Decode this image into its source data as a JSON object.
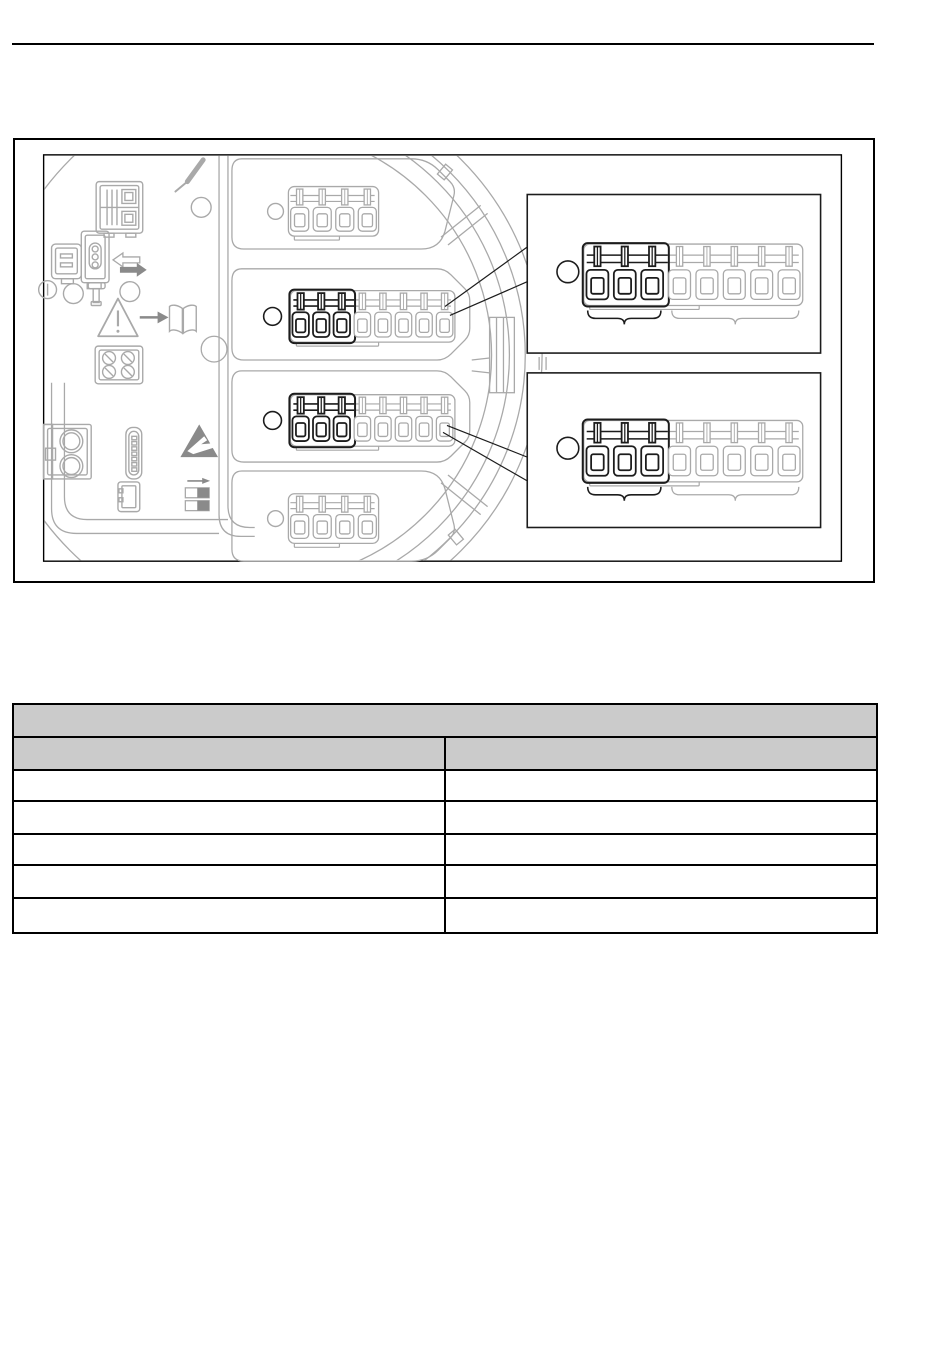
{
  "page": {
    "width": 950,
    "height": 1369,
    "background": "#ffffff"
  },
  "header": {
    "rule_color": "#000000"
  },
  "figure": {
    "caption": "",
    "frame_color": "#000000",
    "drawing": {
      "background": "#ffffff",
      "stroke_light": "#a9a9a9",
      "stroke_dark": "#1c1c1c",
      "icon_fill": "#8a8a8a",
      "housing": {
        "ring_radii": [
          279,
          262,
          246,
          228
        ]
      },
      "terminal_blocks": [
        {
          "id": "top-connector",
          "dark_slots": 0,
          "light_slots": 4
        },
        {
          "id": "middle-terminal-block",
          "dark_slots": 3,
          "light_slots": 5
        },
        {
          "id": "lower-terminal-block",
          "dark_slots": 3,
          "light_slots": 5
        },
        {
          "id": "bottom-connector",
          "dark_slots": 0,
          "light_slots": 4
        }
      ],
      "details": [
        {
          "id": "detail-view-top",
          "dark_slots": 3,
          "light_slots": 5
        },
        {
          "id": "detail-view-bottom",
          "dark_slots": 3,
          "light_slots": 5
        }
      ],
      "icons": [
        "screwdriver-icon",
        "display-connector-icon",
        "interface-connector-icon",
        "swap-arrows-icon",
        "info-circle-icon",
        "key-icon",
        "warning-triangle-icon",
        "arrow-right-icon",
        "open-book-icon",
        "four-pole-connector-icon",
        "round-terminal-connector-icon",
        "pin-header-icon",
        "small-connector-icon",
        "esd-warning-icon",
        "dip-switch-icon"
      ]
    }
  },
  "table": {
    "grid_color": "#000000",
    "header_fill": "#cbcbcb",
    "title": "",
    "columns": [
      {
        "label": ""
      },
      {
        "label": ""
      }
    ],
    "rows": [
      [
        "",
        ""
      ],
      [
        "",
        ""
      ],
      [
        "",
        ""
      ],
      [
        "",
        ""
      ],
      [
        "",
        ""
      ]
    ]
  }
}
